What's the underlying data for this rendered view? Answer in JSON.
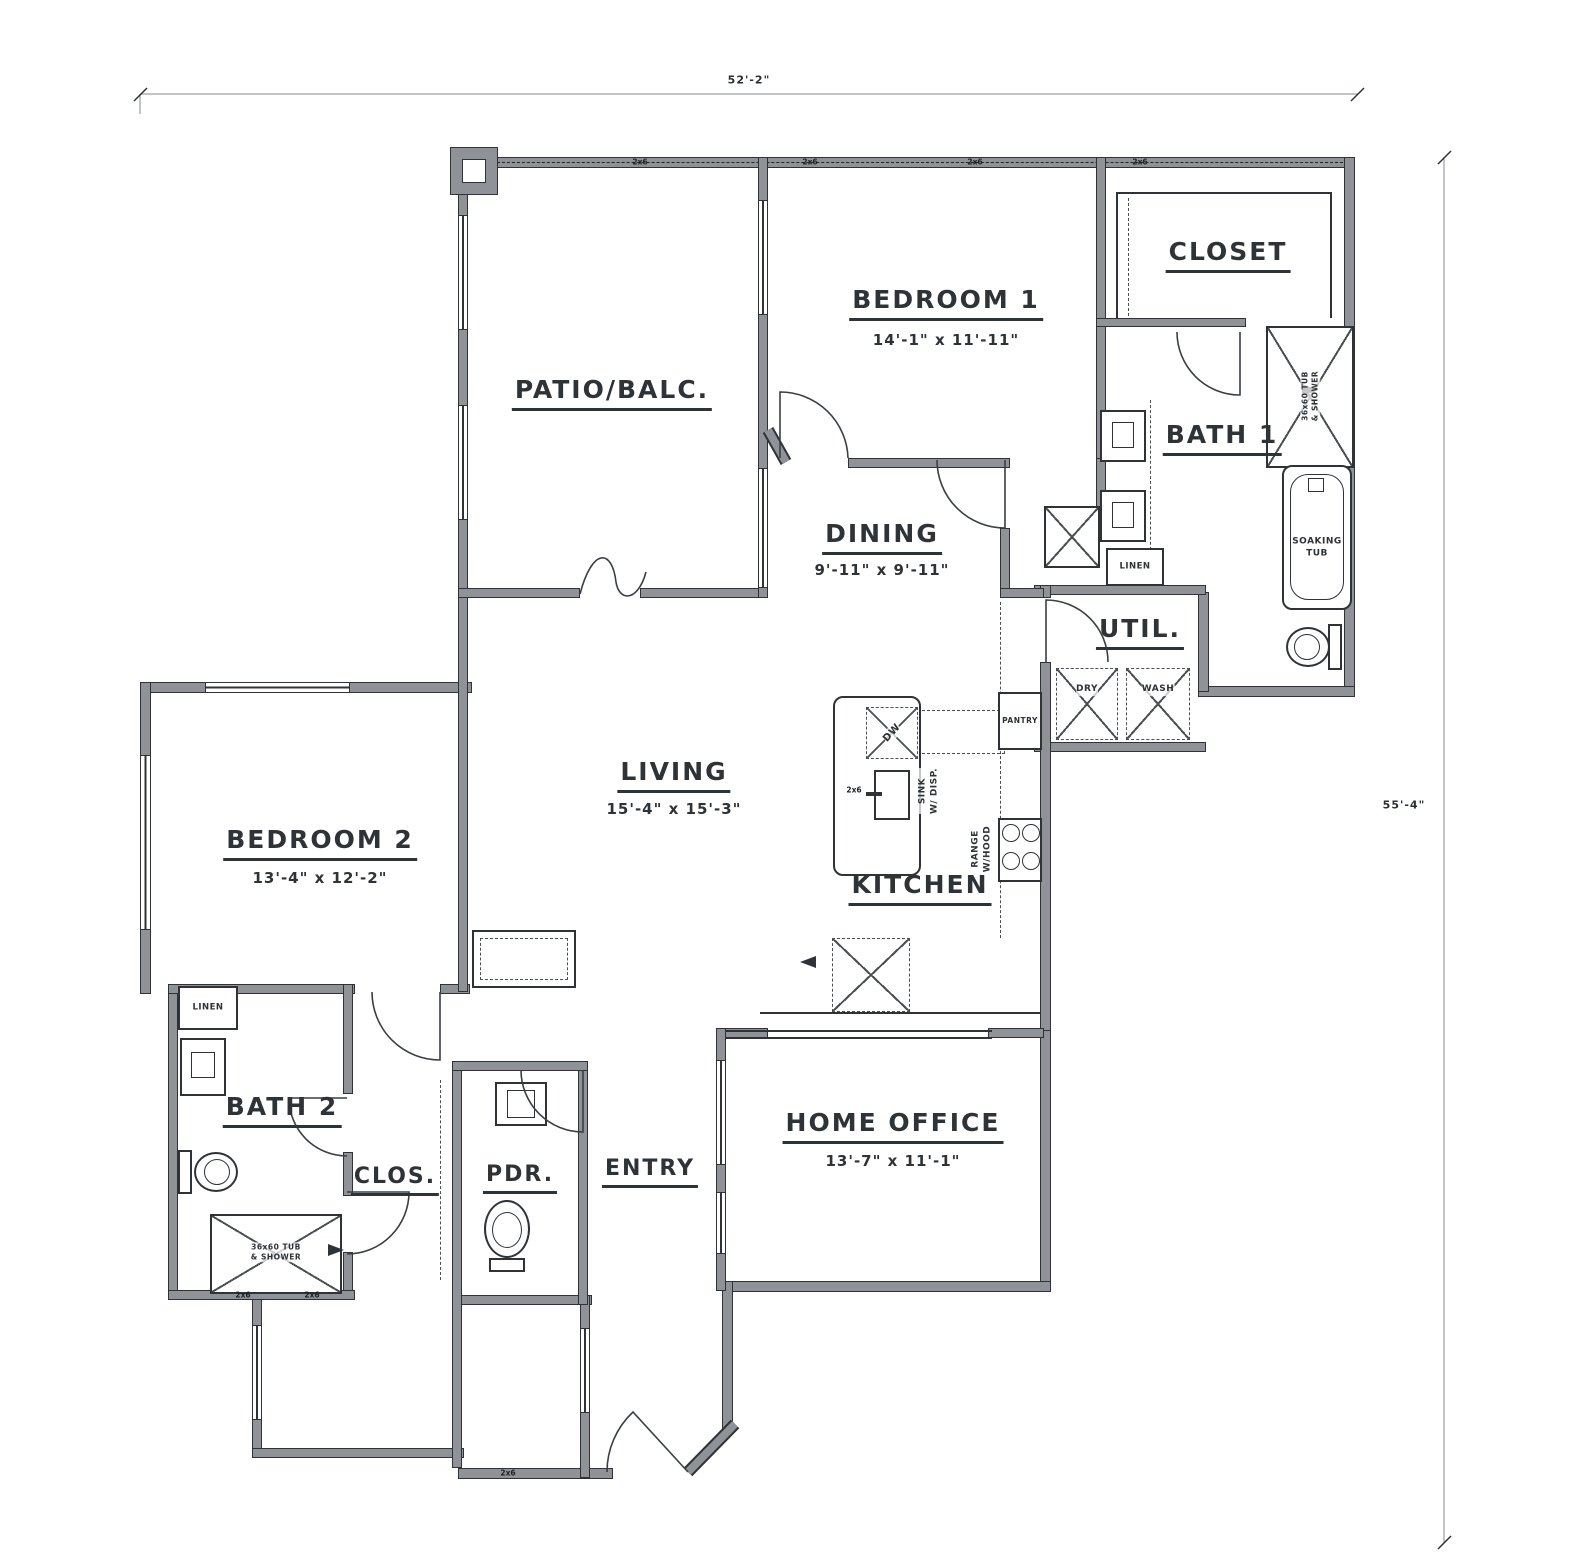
{
  "drawing": {
    "type": "residential unit floor plan",
    "overall_width": "52'-2\"",
    "overall_depth": "55'-4\""
  },
  "rooms": {
    "patio": {
      "label": "PATIO/BALC.",
      "dims": ""
    },
    "bedroom1": {
      "label": "BEDROOM 1",
      "dims": "14'-1\" x 11'-11\""
    },
    "closet1": {
      "label": "CLOSET",
      "dims": ""
    },
    "bath1": {
      "label": "BATH 1",
      "dims": ""
    },
    "dining": {
      "label": "DINING",
      "dims": "9'-11\" x 9'-11\""
    },
    "util": {
      "label": "UTIL.",
      "dims": ""
    },
    "living": {
      "label": "LIVING",
      "dims": "15'-4\" x 15'-3\""
    },
    "bedroom2": {
      "label": "BEDROOM 2",
      "dims": "13'-4\" x 12'-2\""
    },
    "kitchen": {
      "label": "KITCHEN",
      "dims": ""
    },
    "bath2": {
      "label": "BATH 2",
      "dims": ""
    },
    "clos": {
      "label": "CLOS.",
      "dims": ""
    },
    "pdr": {
      "label": "PDR.",
      "dims": ""
    },
    "entry": {
      "label": "ENTRY",
      "dims": ""
    },
    "office": {
      "label": "HOME OFFICE",
      "dims": "13'-7\" x 11'-1\""
    }
  },
  "fixtures": {
    "dw": "DW",
    "sink": "SINK\nW/ DISP.",
    "range": "RANGE\nW/HOOD",
    "pantry": "PANTRY",
    "dry": "DRY",
    "wash": "WASH",
    "linen": "LINEN",
    "soaking_tub": "SOAKING\nTUB",
    "tub_shower": "36x60 TUB\n& SHOWER",
    "stud": "2x6"
  },
  "colors": {
    "paper": "#ffffff",
    "wall_fill": "#8f9296",
    "line": "#2e3338"
  }
}
